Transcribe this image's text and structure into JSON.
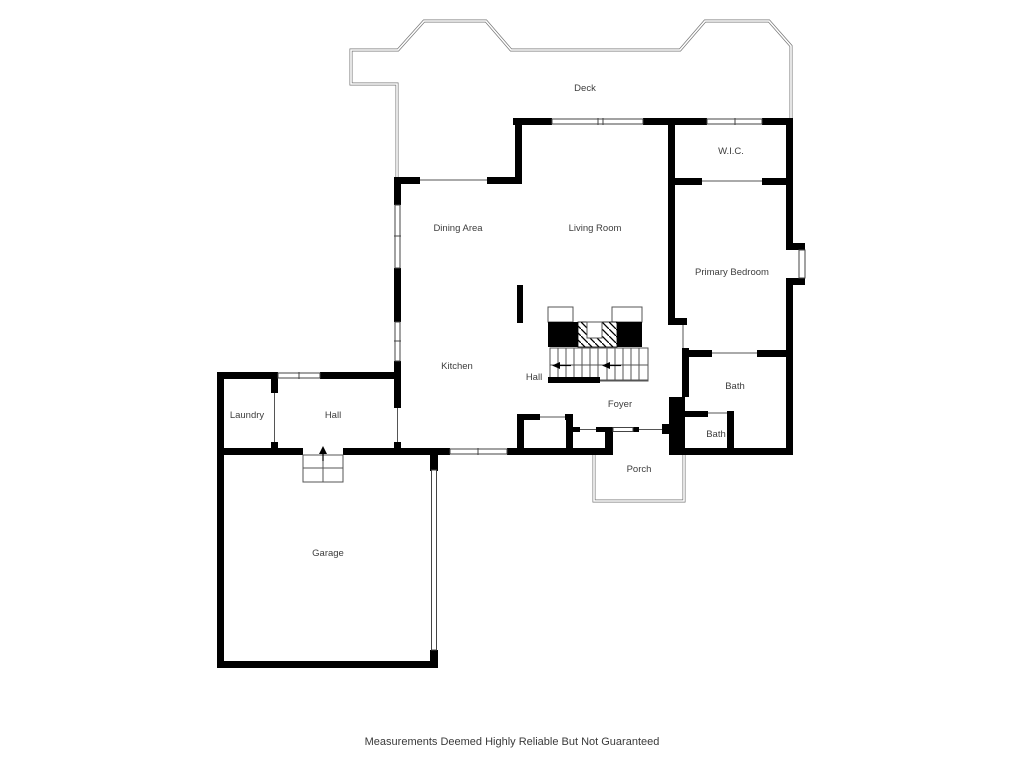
{
  "page": {
    "background": "#ffffff",
    "type": "floor-plan"
  },
  "colors": {
    "wall": "#000000",
    "thin_line": "#555555",
    "text": "#3d3d3d"
  },
  "rooms": {
    "deck": "Deck",
    "wic": "W.I.C.",
    "dining_area": "Dining Area",
    "living_room": "Living Room",
    "primary_bedroom": "Primary Bedroom",
    "kitchen": "Kitchen",
    "hall_center": "Hall",
    "bath_main": "Bath",
    "foyer": "Foyer",
    "laundry": "Laundry",
    "hall_left": "Hall",
    "bath_small": "Bath",
    "porch": "Porch",
    "garage": "Garage"
  },
  "footer": {
    "disclaimer": "Measurements Deemed Highly Reliable But Not Guaranteed"
  }
}
